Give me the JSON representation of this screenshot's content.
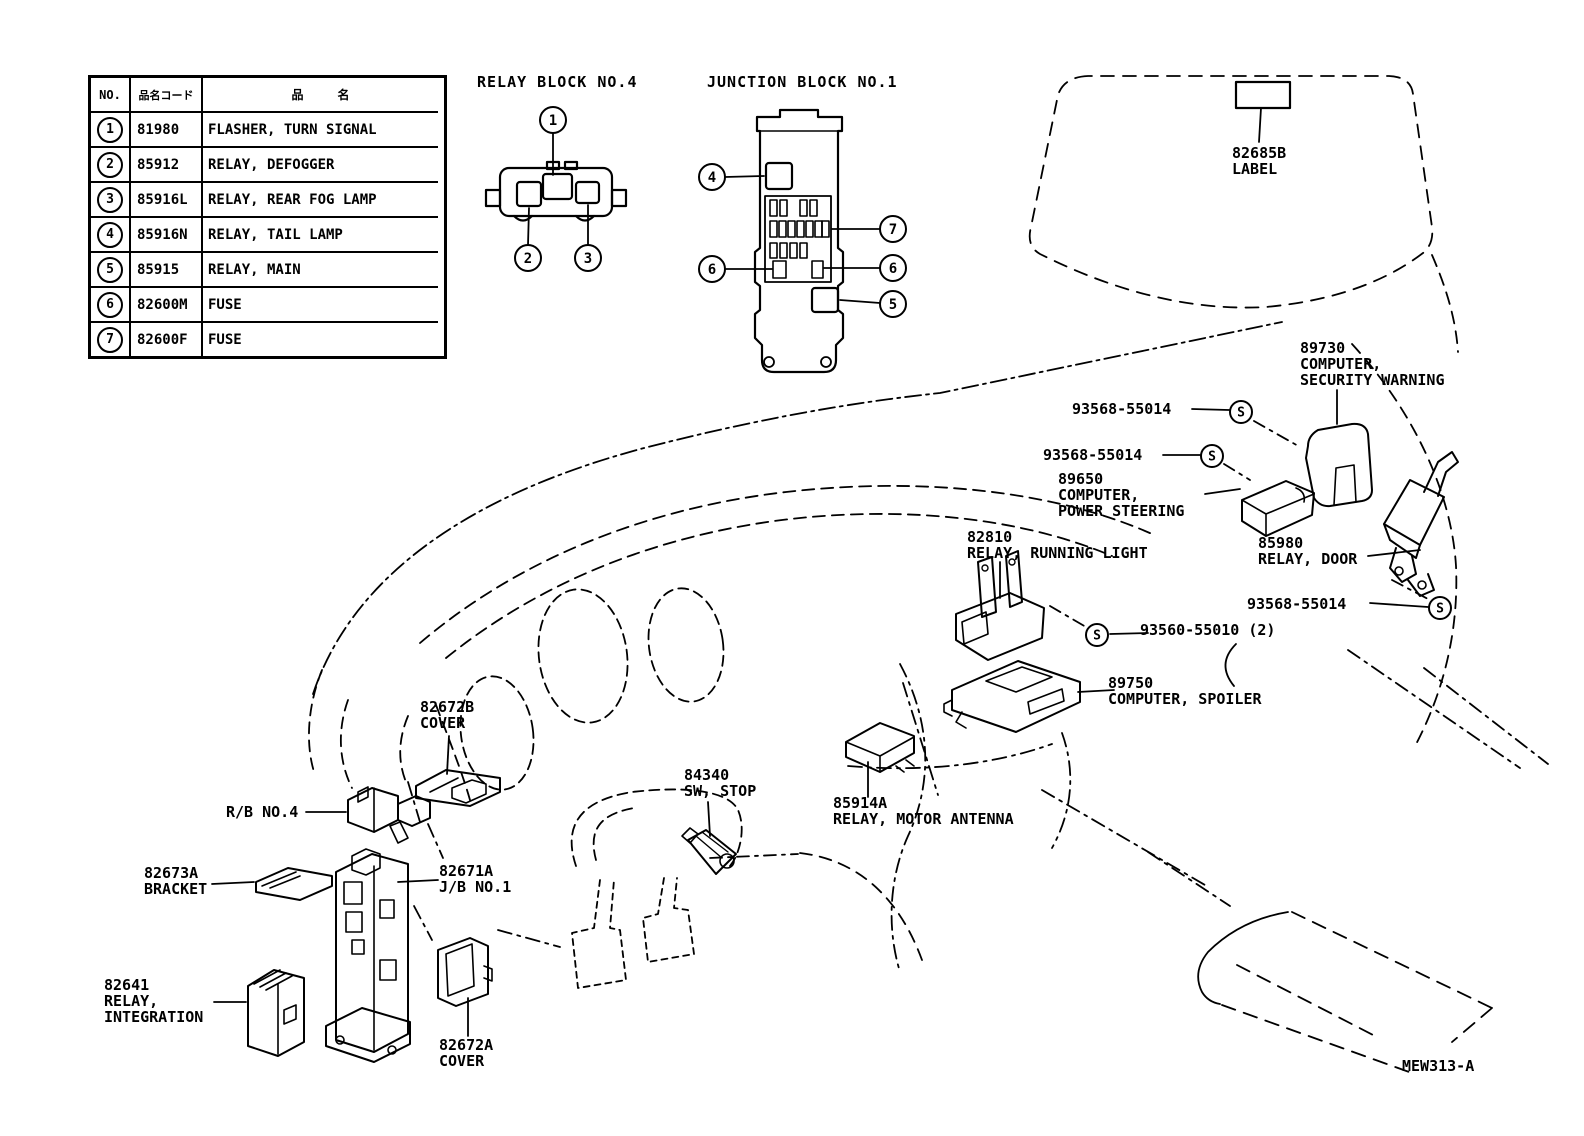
{
  "figure_code": "MEW313-A",
  "legend_table": {
    "col_no": "NO.",
    "col_code": "品名コード",
    "col_name": "品名",
    "rows": [
      {
        "no": "1",
        "code": "81980",
        "name": "FLASHER, TURN SIGNAL"
      },
      {
        "no": "2",
        "code": "85912",
        "name": "RELAY, DEFOGGER"
      },
      {
        "no": "3",
        "code": "85916L",
        "name": "RELAY, REAR FOG LAMP"
      },
      {
        "no": "4",
        "code": "85916N",
        "name": "RELAY, TAIL LAMP"
      },
      {
        "no": "5",
        "code": "85915",
        "name": "RELAY, MAIN"
      },
      {
        "no": "6",
        "code": "82600M",
        "name": "FUSE"
      },
      {
        "no": "7",
        "code": "82600F",
        "name": "FUSE"
      }
    ]
  },
  "relay_block": {
    "title": "RELAY BLOCK NO.4",
    "callout_1": "1",
    "callout_2": "2",
    "callout_3": "3"
  },
  "junction_block": {
    "title": "JUNCTION BLOCK NO.1",
    "callout_4": "4",
    "callout_7": "7",
    "callout_6a": "6",
    "callout_6b": "6",
    "callout_5": "5"
  },
  "s_marker": "S",
  "part_labels": {
    "label_82685b": "82685B\nLABEL",
    "computer_security": "89730\nCOMPUTER,\nSECURITY WARNING",
    "screw_1": "93568-55014",
    "screw_2": "93568-55014",
    "computer_power_steering": "89650\nCOMPUTER,\nPOWER STEERING",
    "relay_running_light": "82810\nRELAY, RUNNING LIGHT",
    "relay_door": "85980\nRELAY, DOOR",
    "screw_3": "93568-55014",
    "screw_4": "93560-55010 (2)",
    "computer_spoiler": "89750\nCOMPUTER, SPOILER",
    "sw_stop": "84340\nSW, STOP",
    "relay_motor_antenna": "85914A\nRELAY, MOTOR ANTENNA",
    "cover_b": "82672B\nCOVER",
    "rb_no4": "R/B NO.4",
    "bracket": "82673A\nBRACKET",
    "jb_no1": "82671A\nJ/B NO.1",
    "relay_integration": "82641\nRELAY,\nINTEGRATION",
    "cover_a": "82672A\nCOVER"
  }
}
